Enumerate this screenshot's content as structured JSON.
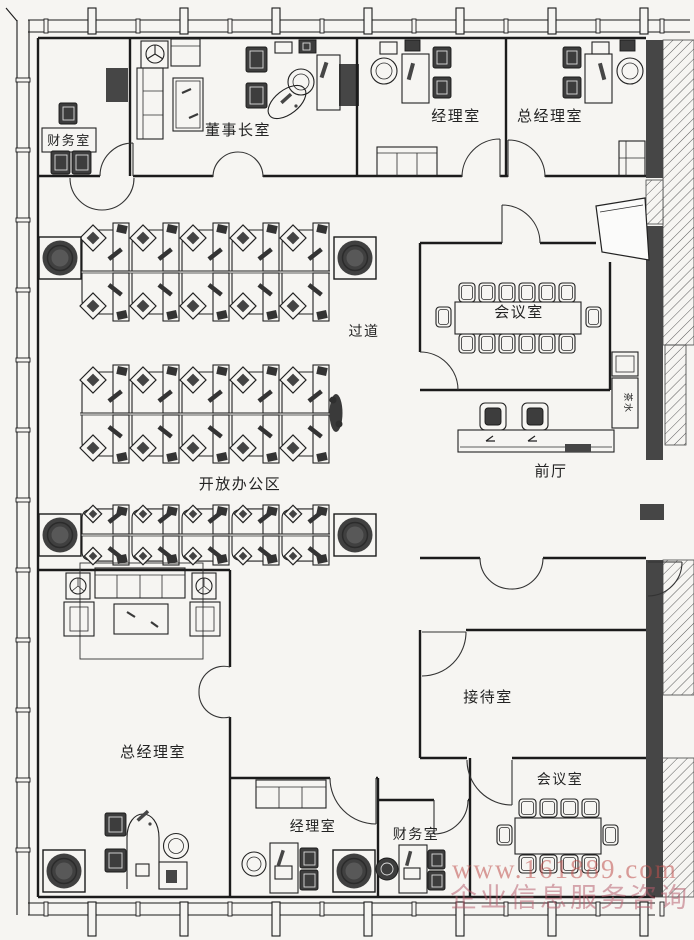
{
  "rooms": {
    "finance_top": "财务室",
    "chairman": "董事长室",
    "manager_top": "经理室",
    "gm_top": "总经理室",
    "meeting_top": "会议室",
    "corridor": "过道",
    "open_office": "开放办公区",
    "front_hall": "前厅",
    "pantry": "茶水",
    "gm_bottom": "总经理室",
    "reception": "接待室",
    "manager_bottom": "经理室",
    "finance_bottom": "财务室",
    "meeting_bottom": "会议室"
  },
  "watermark": {
    "line1": "www.161889.com",
    "line2": "企业信息服务咨询"
  },
  "colors": {
    "wall": "#1b1b1b",
    "dark_fill": "#464646",
    "background": "#f6f5f2",
    "watermark_line1": "#c0504d",
    "watermark_line2": "#b65b6b"
  }
}
